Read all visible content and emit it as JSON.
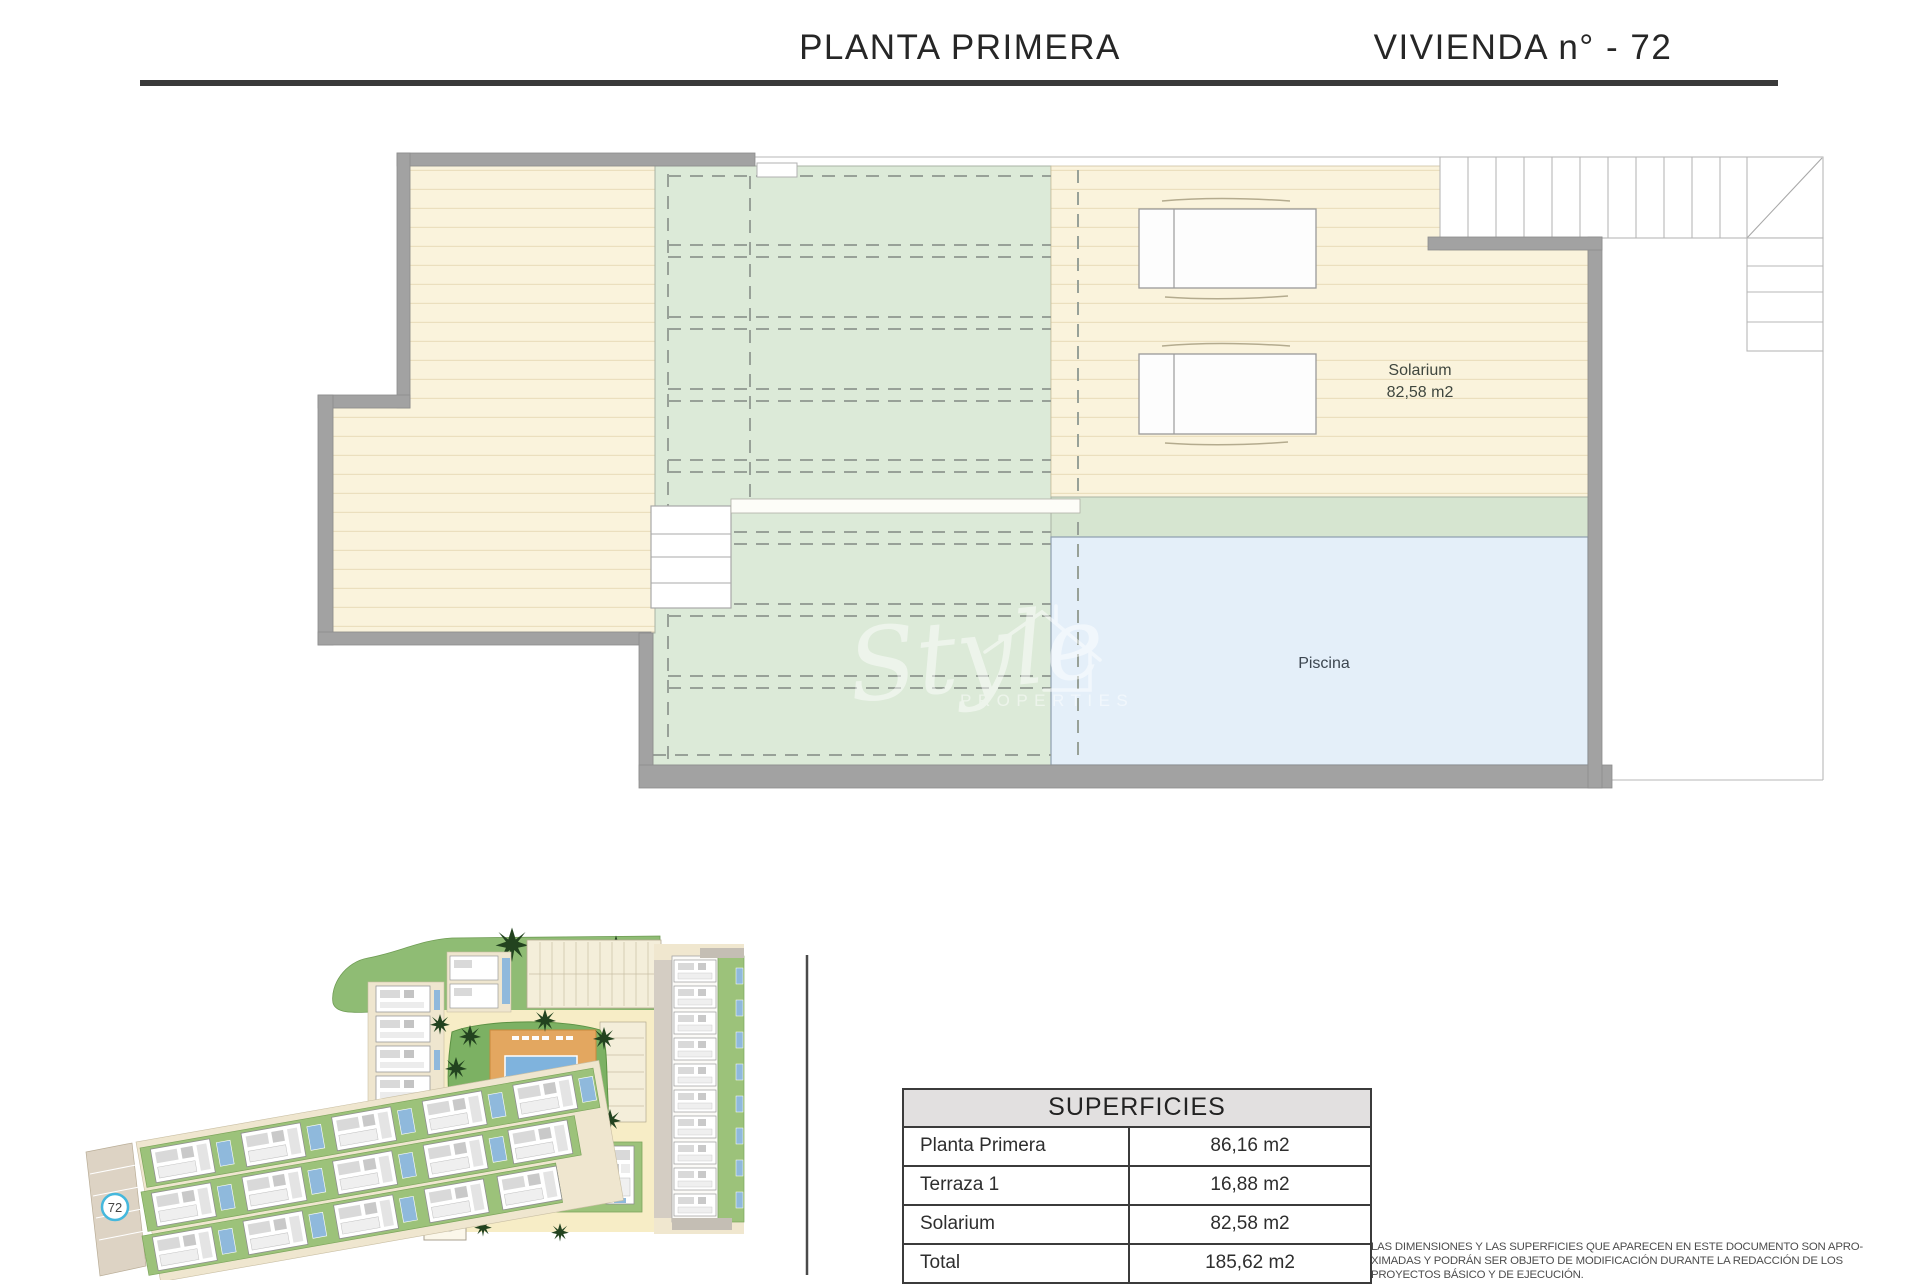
{
  "header": {
    "left_title": "PLANTA PRIMERA",
    "right_title": "VIVIENDA n° - 72"
  },
  "plan": {
    "solarium_label": "Solarium",
    "solarium_area": "82,58 m2",
    "pool_label": "Piscina"
  },
  "watermark": {
    "script": "Style",
    "caps": "PROPERTIES"
  },
  "siteplan": {
    "unit_marker": "72"
  },
  "table": {
    "title": "SUPERFICIES",
    "rows": [
      {
        "label": "Planta Primera",
        "value": "86,16 m2"
      },
      {
        "label": "Terraza 1",
        "value": "16,88 m2"
      },
      {
        "label": "Solarium",
        "value": "82,58 m2"
      },
      {
        "label": "Total",
        "value": "185,62 m2"
      }
    ]
  },
  "disclaimer": {
    "line1": "LAS DIMENSIONES Y LAS SUPERFICIES QUE APARECEN EN ESTE DOCUMENTO SON APRO-",
    "line2": "XIMADAS Y PODRÁN SER OBJETO DE MODIFICACIÓN DURANTE LA REDACCIÓN DE LOS",
    "line3": "PROYECTOS BÁSICO Y DE EJECUCIÓN."
  },
  "colors": {
    "deck_cream": "#faf3dc",
    "terrace_green": "#dcead8",
    "pool_blue": "#e4eff9",
    "wall_gray": "#a2a2a2",
    "marker_accent": "#45b8dd"
  }
}
